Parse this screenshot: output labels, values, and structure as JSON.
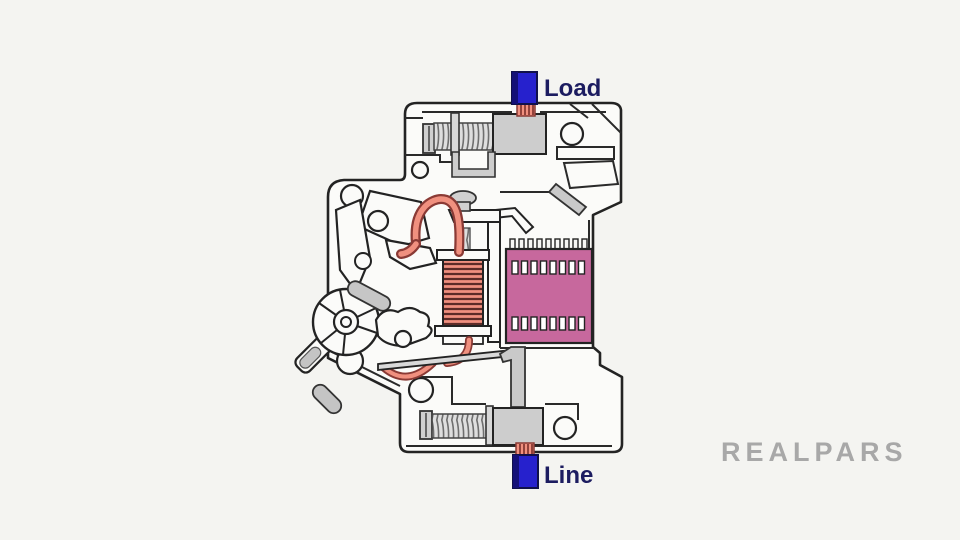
{
  "labels": {
    "load": "Load",
    "line": "Line"
  },
  "watermark": {
    "text": "REALPARS"
  },
  "colors": {
    "background": "#f4f4f1",
    "label_text": "#1c1c60",
    "terminal_blue": "#2621cd",
    "terminal_blue_shadow": "#141077",
    "copper_light": "#f0907f",
    "copper_dark": "#8a3a35",
    "arc_chute_pink": "#c7689d",
    "metal_gray": "#cdcdcd",
    "metal_gray_dark": "#c4c4c4",
    "housing_white": "#fbfbf9",
    "outline_dark": "#232323",
    "watermark_gray": "#a2a2a2"
  }
}
